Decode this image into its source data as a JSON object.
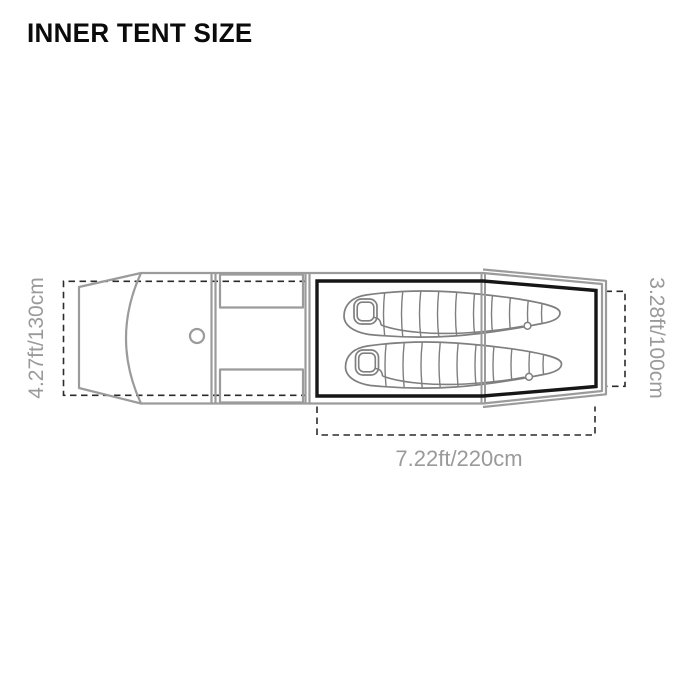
{
  "title": "INNER TENT SIZE",
  "diagram": {
    "type": "tent-floor-plan-top-view",
    "dim_left": "4.27ft/130cm",
    "dim_right": "3.28ft/100cm",
    "dim_bottom": "7.22ft/220cm",
    "colors": {
      "tent_outline": "#9b9b9b",
      "inner_tent_outline": "#161616",
      "dimension_dashes": "#2b2b2b",
      "labels": "#9a9a9a",
      "sleeping_bag_lines": "#7f7f7f",
      "background": "#ffffff"
    },
    "parts": [
      "vestibule-with-door-arc",
      "vent-circle",
      "storage-pocket-top",
      "storage-pocket-bottom",
      "inner-tent-floor",
      "sleeping-bag-1",
      "sleeping-bag-2"
    ]
  }
}
